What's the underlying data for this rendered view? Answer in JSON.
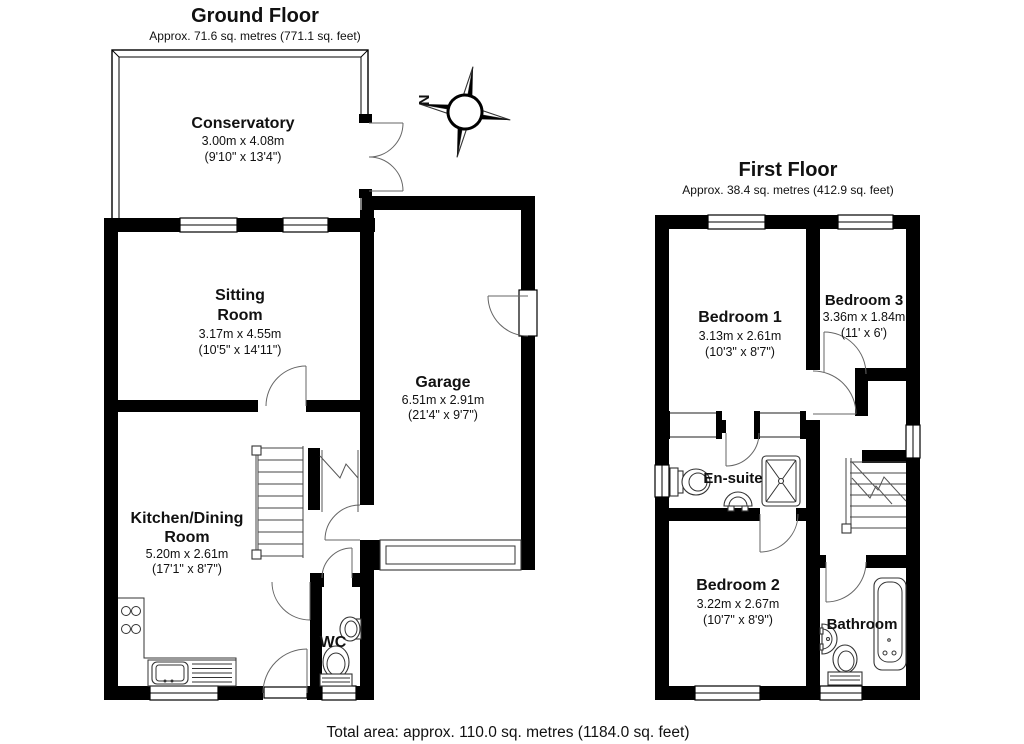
{
  "ground_floor": {
    "title": "Ground Floor",
    "area": "Approx. 71.6 sq. metres (771.1 sq. feet)",
    "compass": "N",
    "rooms": {
      "conservatory": {
        "name": "Conservatory",
        "metric": "3.00m x 4.08m",
        "imperial": "(9'10\" x 13'4\")"
      },
      "sitting_room": {
        "line1": "Sitting",
        "line2": "Room",
        "metric": "3.17m x 4.55m",
        "imperial": "(10'5\" x 14'11\")"
      },
      "garage": {
        "name": "Garage",
        "metric": "6.51m x 2.91m",
        "imperial": "(21'4\" x 9'7\")"
      },
      "kitchen": {
        "line1": "Kitchen/Dining",
        "line2": "Room",
        "metric": "5.20m x 2.61m",
        "imperial": "(17'1\" x 8'7\")"
      },
      "wc": {
        "name": "WC"
      }
    }
  },
  "first_floor": {
    "title": "First Floor",
    "area": "Approx. 38.4 sq. metres (412.9 sq. feet)",
    "rooms": {
      "bedroom1": {
        "name": "Bedroom 1",
        "metric": "3.13m x 2.61m",
        "imperial": "(10'3\" x 8'7\")"
      },
      "bedroom3": {
        "name": "Bedroom 3",
        "metric": "3.36m x 1.84m",
        "imperial": "(11' x 6')"
      },
      "ensuite": {
        "name": "En-suite"
      },
      "bedroom2": {
        "name": "Bedroom 2",
        "metric": "3.22m x 2.67m",
        "imperial": "(10'7\" x 8'9\")"
      },
      "bathroom": {
        "name": "Bathroom"
      }
    }
  },
  "footer": {
    "total": "Total area: approx. 110.0 sq. metres (1184.0 sq. feet)"
  },
  "colors": {
    "wall": "#000000",
    "background": "#ffffff"
  }
}
